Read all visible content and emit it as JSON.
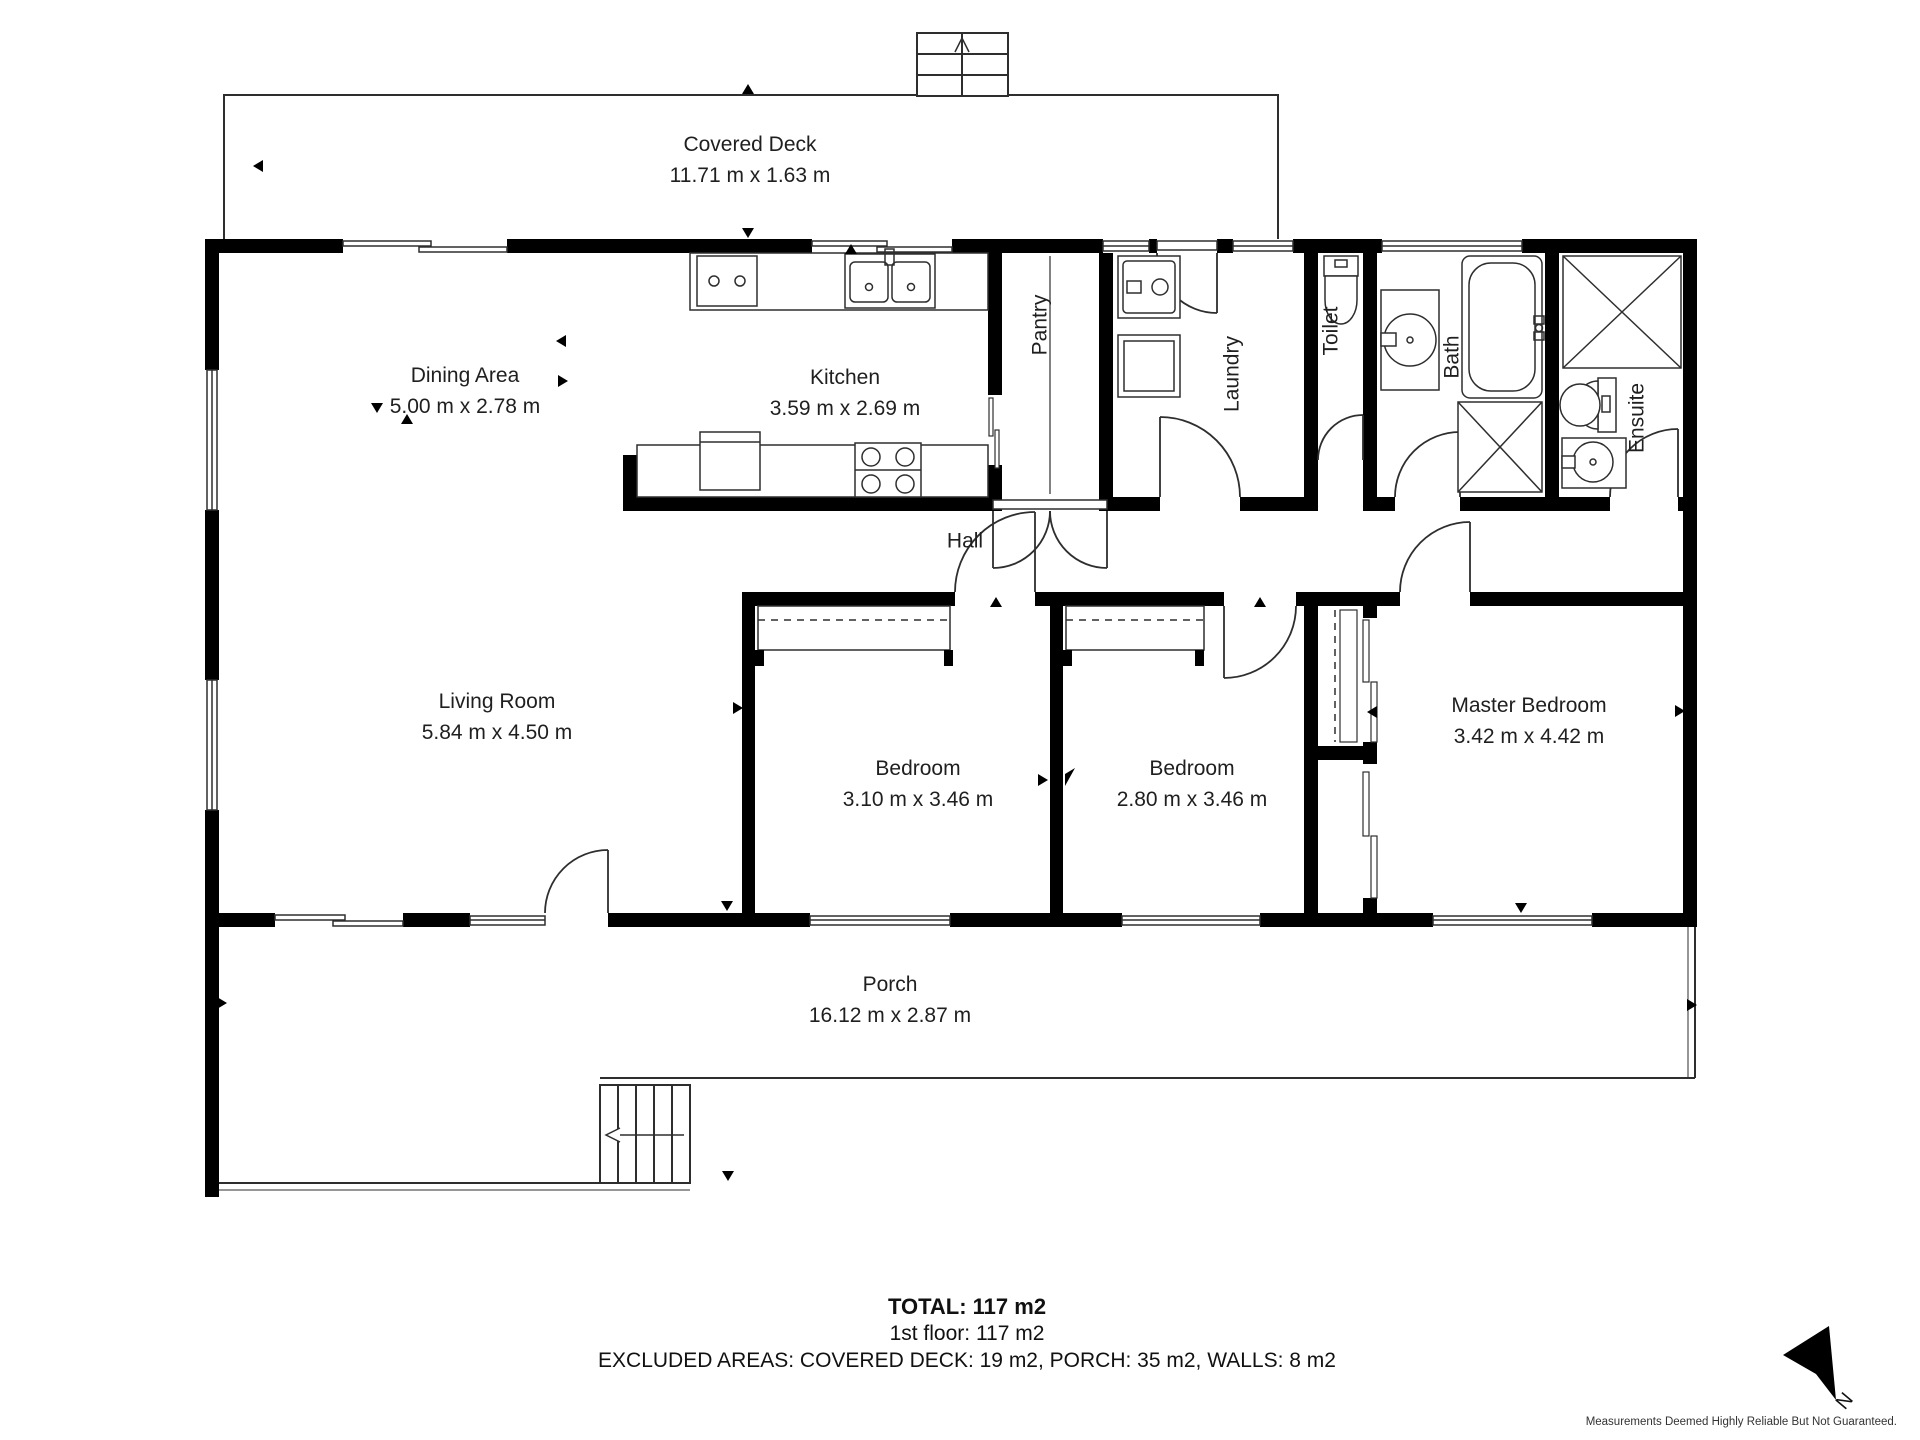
{
  "rooms": {
    "covered_deck": {
      "name": "Covered Deck",
      "dims": "11.71 m x 1.63 m"
    },
    "dining": {
      "name": "Dining Area",
      "dims": "5.00 m x 2.78 m"
    },
    "kitchen": {
      "name": "Kitchen",
      "dims": "3.59 m x 2.69 m"
    },
    "pantry": {
      "name": "Pantry"
    },
    "laundry": {
      "name": "Laundry"
    },
    "toilet": {
      "name": "Toilet"
    },
    "bath": {
      "name": "Bath"
    },
    "ensuite": {
      "name": "Ensuite"
    },
    "hall": {
      "name": "Hall"
    },
    "living": {
      "name": "Living Room",
      "dims": "5.84 m x 4.50 m"
    },
    "bedroom1": {
      "name": "Bedroom",
      "dims": "3.10 m x 3.46 m"
    },
    "bedroom2": {
      "name": "Bedroom",
      "dims": "2.80 m x 3.46 m"
    },
    "master": {
      "name": "Master Bedroom",
      "dims": "3.42 m x 4.42 m"
    },
    "porch": {
      "name": "Porch",
      "dims": "16.12 m x 2.87 m"
    }
  },
  "summary": {
    "total": "TOTAL: 117 m2",
    "floor1": "1st floor: 117 m2",
    "excluded": "EXCLUDED AREAS: COVERED DECK: 19 m2, PORCH: 35 m2, WALLS: 8 m2"
  },
  "footer": {
    "disclaimer": "Measurements Deemed Highly Reliable But Not Guaranteed.",
    "compass": "N"
  },
  "colors": {
    "wall": "#000000",
    "line": "#2e2e2e",
    "text": "#1f1f1f"
  }
}
